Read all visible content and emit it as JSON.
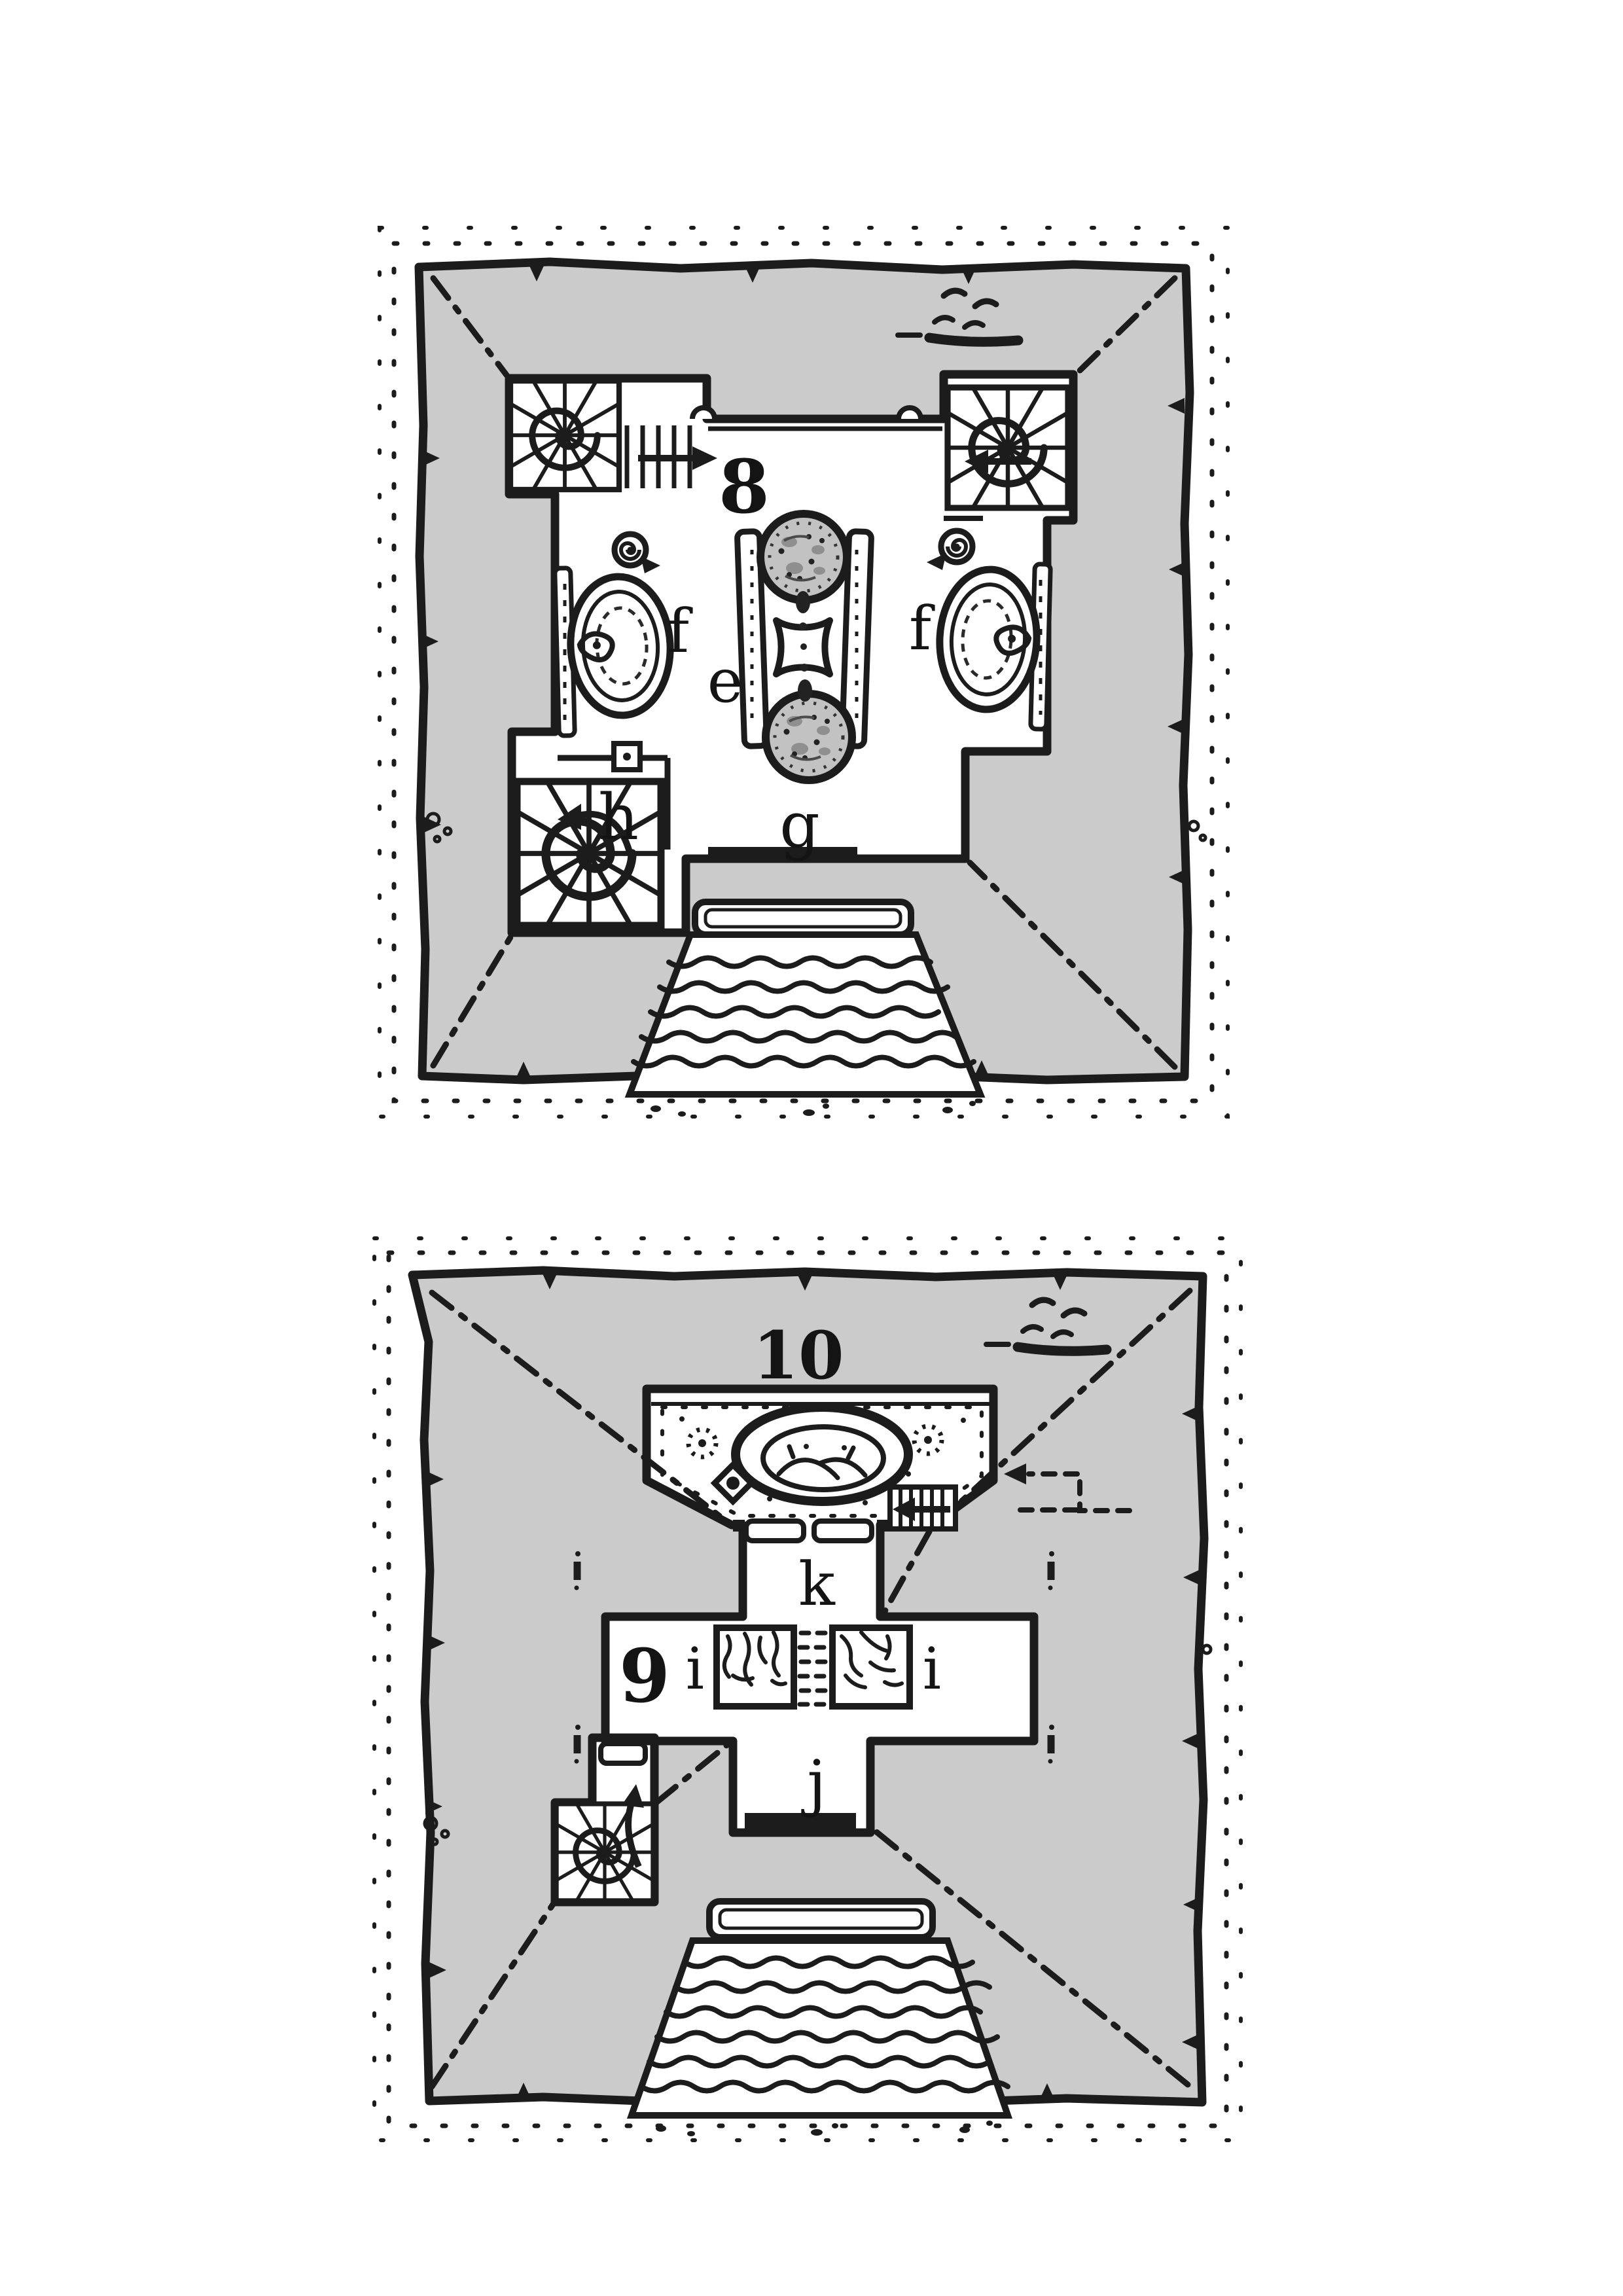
{
  "page": {
    "background": "#ffffff",
    "ink": "#1c1c1c",
    "roof_gray": "#cbcbcb",
    "dome_gray": "#c2c2c2"
  },
  "plans": [
    {
      "name": "level-8-floor-plan",
      "labels": {
        "number": "8",
        "shrine": "e",
        "basin_west": "f",
        "basin_east": "f",
        "entry_hall": "g",
        "stair_room": "h"
      },
      "features": [
        "spiral-staircase-northwest",
        "spiral-staircase-northeast",
        "spiral-staircase-southwest",
        "mosaic-dome-north",
        "mosaic-dome-south",
        "altar",
        "serpent-basin-west",
        "serpent-basin-east",
        "ammonite-shell-west",
        "ammonite-shell-east",
        "entry-door-bar",
        "entrance-steps",
        "hip-roof-ridges"
      ]
    },
    {
      "name": "levels-9-10-floor-plan",
      "labels": {
        "number": "9",
        "balcony": "10",
        "pillar_west": "i",
        "pillar_east": "i",
        "south_door": "j",
        "north_passage": "k"
      },
      "features": [
        "balcony-pool",
        "ladder",
        "spiral-staircase-southwest",
        "cracked-pillar-west",
        "cracked-pillar-east",
        "south-door-bar",
        "entrance-steps",
        "dashed-route-arrow",
        "wall-sconces",
        "hip-roof-ridges"
      ]
    }
  ]
}
